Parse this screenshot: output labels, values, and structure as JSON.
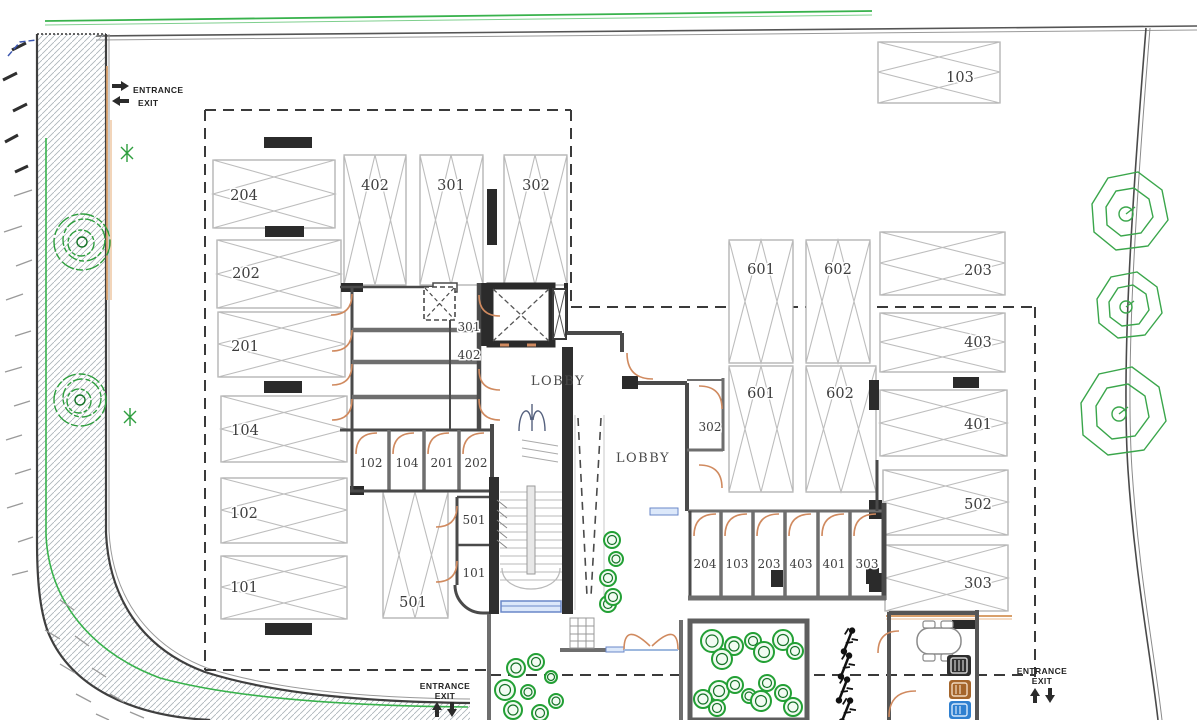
{
  "lobbies": {
    "upper": "LOBBY",
    "lower": "LOBBY"
  },
  "entrances": {
    "top_left": {
      "entrance": "ENTRANCE",
      "exit": "EXIT"
    },
    "bottom_center": {
      "entrance": "ENTRANCE",
      "exit": "EXIT"
    },
    "bottom_right": {
      "entrance": "ENTRANCE",
      "exit": "EXIT"
    }
  },
  "parking": {
    "left_column": [
      "204",
      "202",
      "201",
      "104",
      "102",
      "101"
    ],
    "top_row": [
      "402",
      "301",
      "302"
    ],
    "top_right": "103",
    "right_column": [
      "203",
      "403",
      "401",
      "502",
      "303"
    ],
    "center_upper": [
      "601",
      "602"
    ],
    "center_lower": [
      "601",
      "602"
    ],
    "ramp_bay": "501"
  },
  "storage_rooms": {
    "core_stack": [
      "301",
      "402"
    ],
    "mid_row": [
      "102",
      "104",
      "201",
      "202"
    ],
    "stair_side": [
      "501",
      "101"
    ],
    "lobby_side": "302",
    "south_row": [
      "204",
      "103",
      "203",
      "403",
      "401",
      "303"
    ]
  },
  "colors": {
    "boundary_green": "#38b24c",
    "door_orange": "#d08a5f",
    "window_blue": "#6a87c8",
    "bin_dark": "#2e2e2e",
    "bin_brown": "#a5662c",
    "bin_blue": "#2f80d0",
    "bush_green": "#23a035",
    "tree_green": "#3aa64b"
  }
}
